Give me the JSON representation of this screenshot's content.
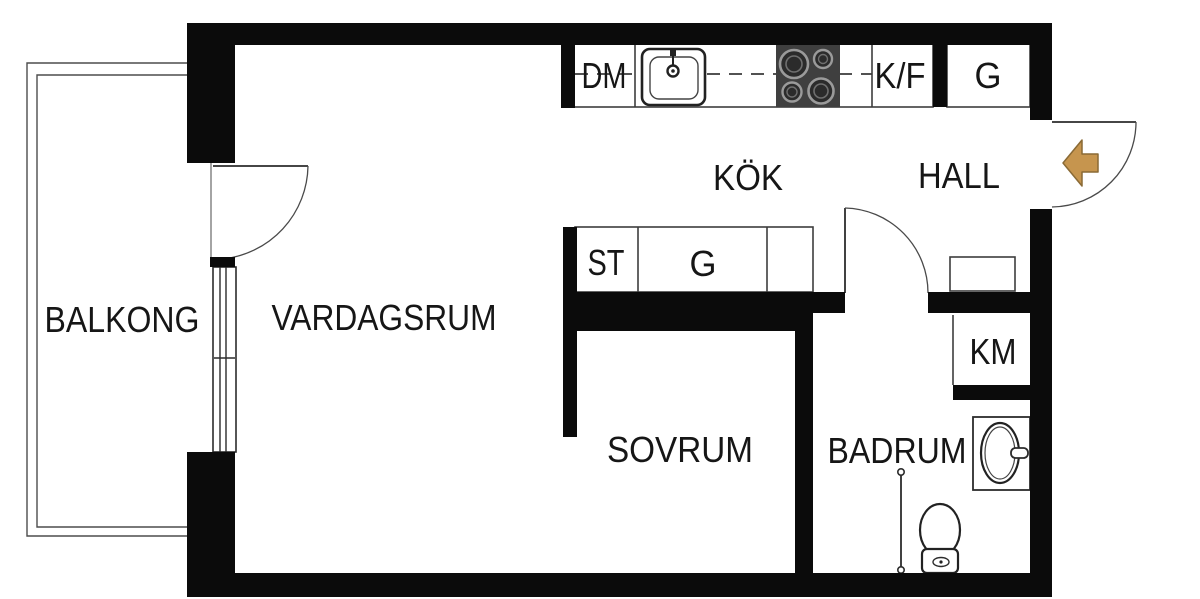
{
  "plan": {
    "rooms": {
      "balcony": {
        "label": "BALKONG"
      },
      "living_room": {
        "label": "VARDAGSRUM"
      },
      "kitchen": {
        "label": "KÖK"
      },
      "hall": {
        "label": "HALL"
      },
      "bedroom": {
        "label": "SOVRUM"
      },
      "bathroom": {
        "label": "BADRUM"
      }
    },
    "fixtures": {
      "dishwasher": {
        "label": "DM"
      },
      "fridge_freezer": {
        "label": "K/F"
      },
      "hall_wardrobe": {
        "label": "G"
      },
      "cleaning_closet": {
        "label": "ST"
      },
      "wardrobe": {
        "label": "G"
      },
      "washing_machine": {
        "label": "KM"
      }
    },
    "colors": {
      "wall": "#0b0b0b",
      "background": "#ffffff",
      "outline": "#3d3d3d",
      "stove": "#3f3f3f",
      "entry_arrow_fill": "#c6954e",
      "entry_arrow_stroke": "#8a6a35"
    }
  }
}
